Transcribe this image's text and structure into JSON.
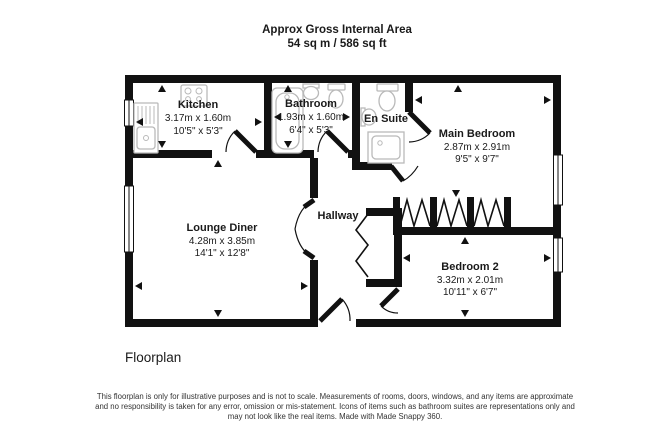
{
  "header": {
    "title_line1": "Approx Gross Internal Area",
    "title_line2": "54 sq m / 586 sq ft"
  },
  "rooms": {
    "kitchen": {
      "name": "Kitchen",
      "dims_metric": "3.17m x 1.60m",
      "dims_imperial": "10'5\" x 5'3\""
    },
    "bathroom": {
      "name": "Bathroom",
      "dims_metric": "1.93m x 1.60m",
      "dims_imperial": "6'4\" x 5'3\""
    },
    "en_suite": {
      "name": "En Suite"
    },
    "main_bedroom": {
      "name": "Main Bedroom",
      "dims_metric": "2.87m x 2.91m",
      "dims_imperial": "9'5\" x 9'7\""
    },
    "lounge_diner": {
      "name": "Lounge Diner",
      "dims_metric": "4.28m x 3.85m",
      "dims_imperial": "14'1\" x 12'8\""
    },
    "hallway": {
      "name": "Hallway"
    },
    "bedroom_2": {
      "name": "Bedroom 2",
      "dims_metric": "3.32m x 2.01m",
      "dims_imperial": "10'11\" x 6'7\""
    }
  },
  "footer": {
    "caption": "Floorplan",
    "disclaimer_line1": "This floorplan is only for illustrative purposes and is not to scale. Measurements of rooms, doors, windows, and any items are approximate",
    "disclaimer_line2": "and no responsibility is taken for any error, omission or mis-statement. Icons of items such as bathroom suites are representations only and",
    "disclaimer_line3": "may not look like the real items. Made with Made Snappy 360."
  },
  "colors": {
    "wall": "#111111",
    "fixture_stroke": "#b9b9b9",
    "text": "#1a1a1a",
    "background": "#ffffff"
  }
}
